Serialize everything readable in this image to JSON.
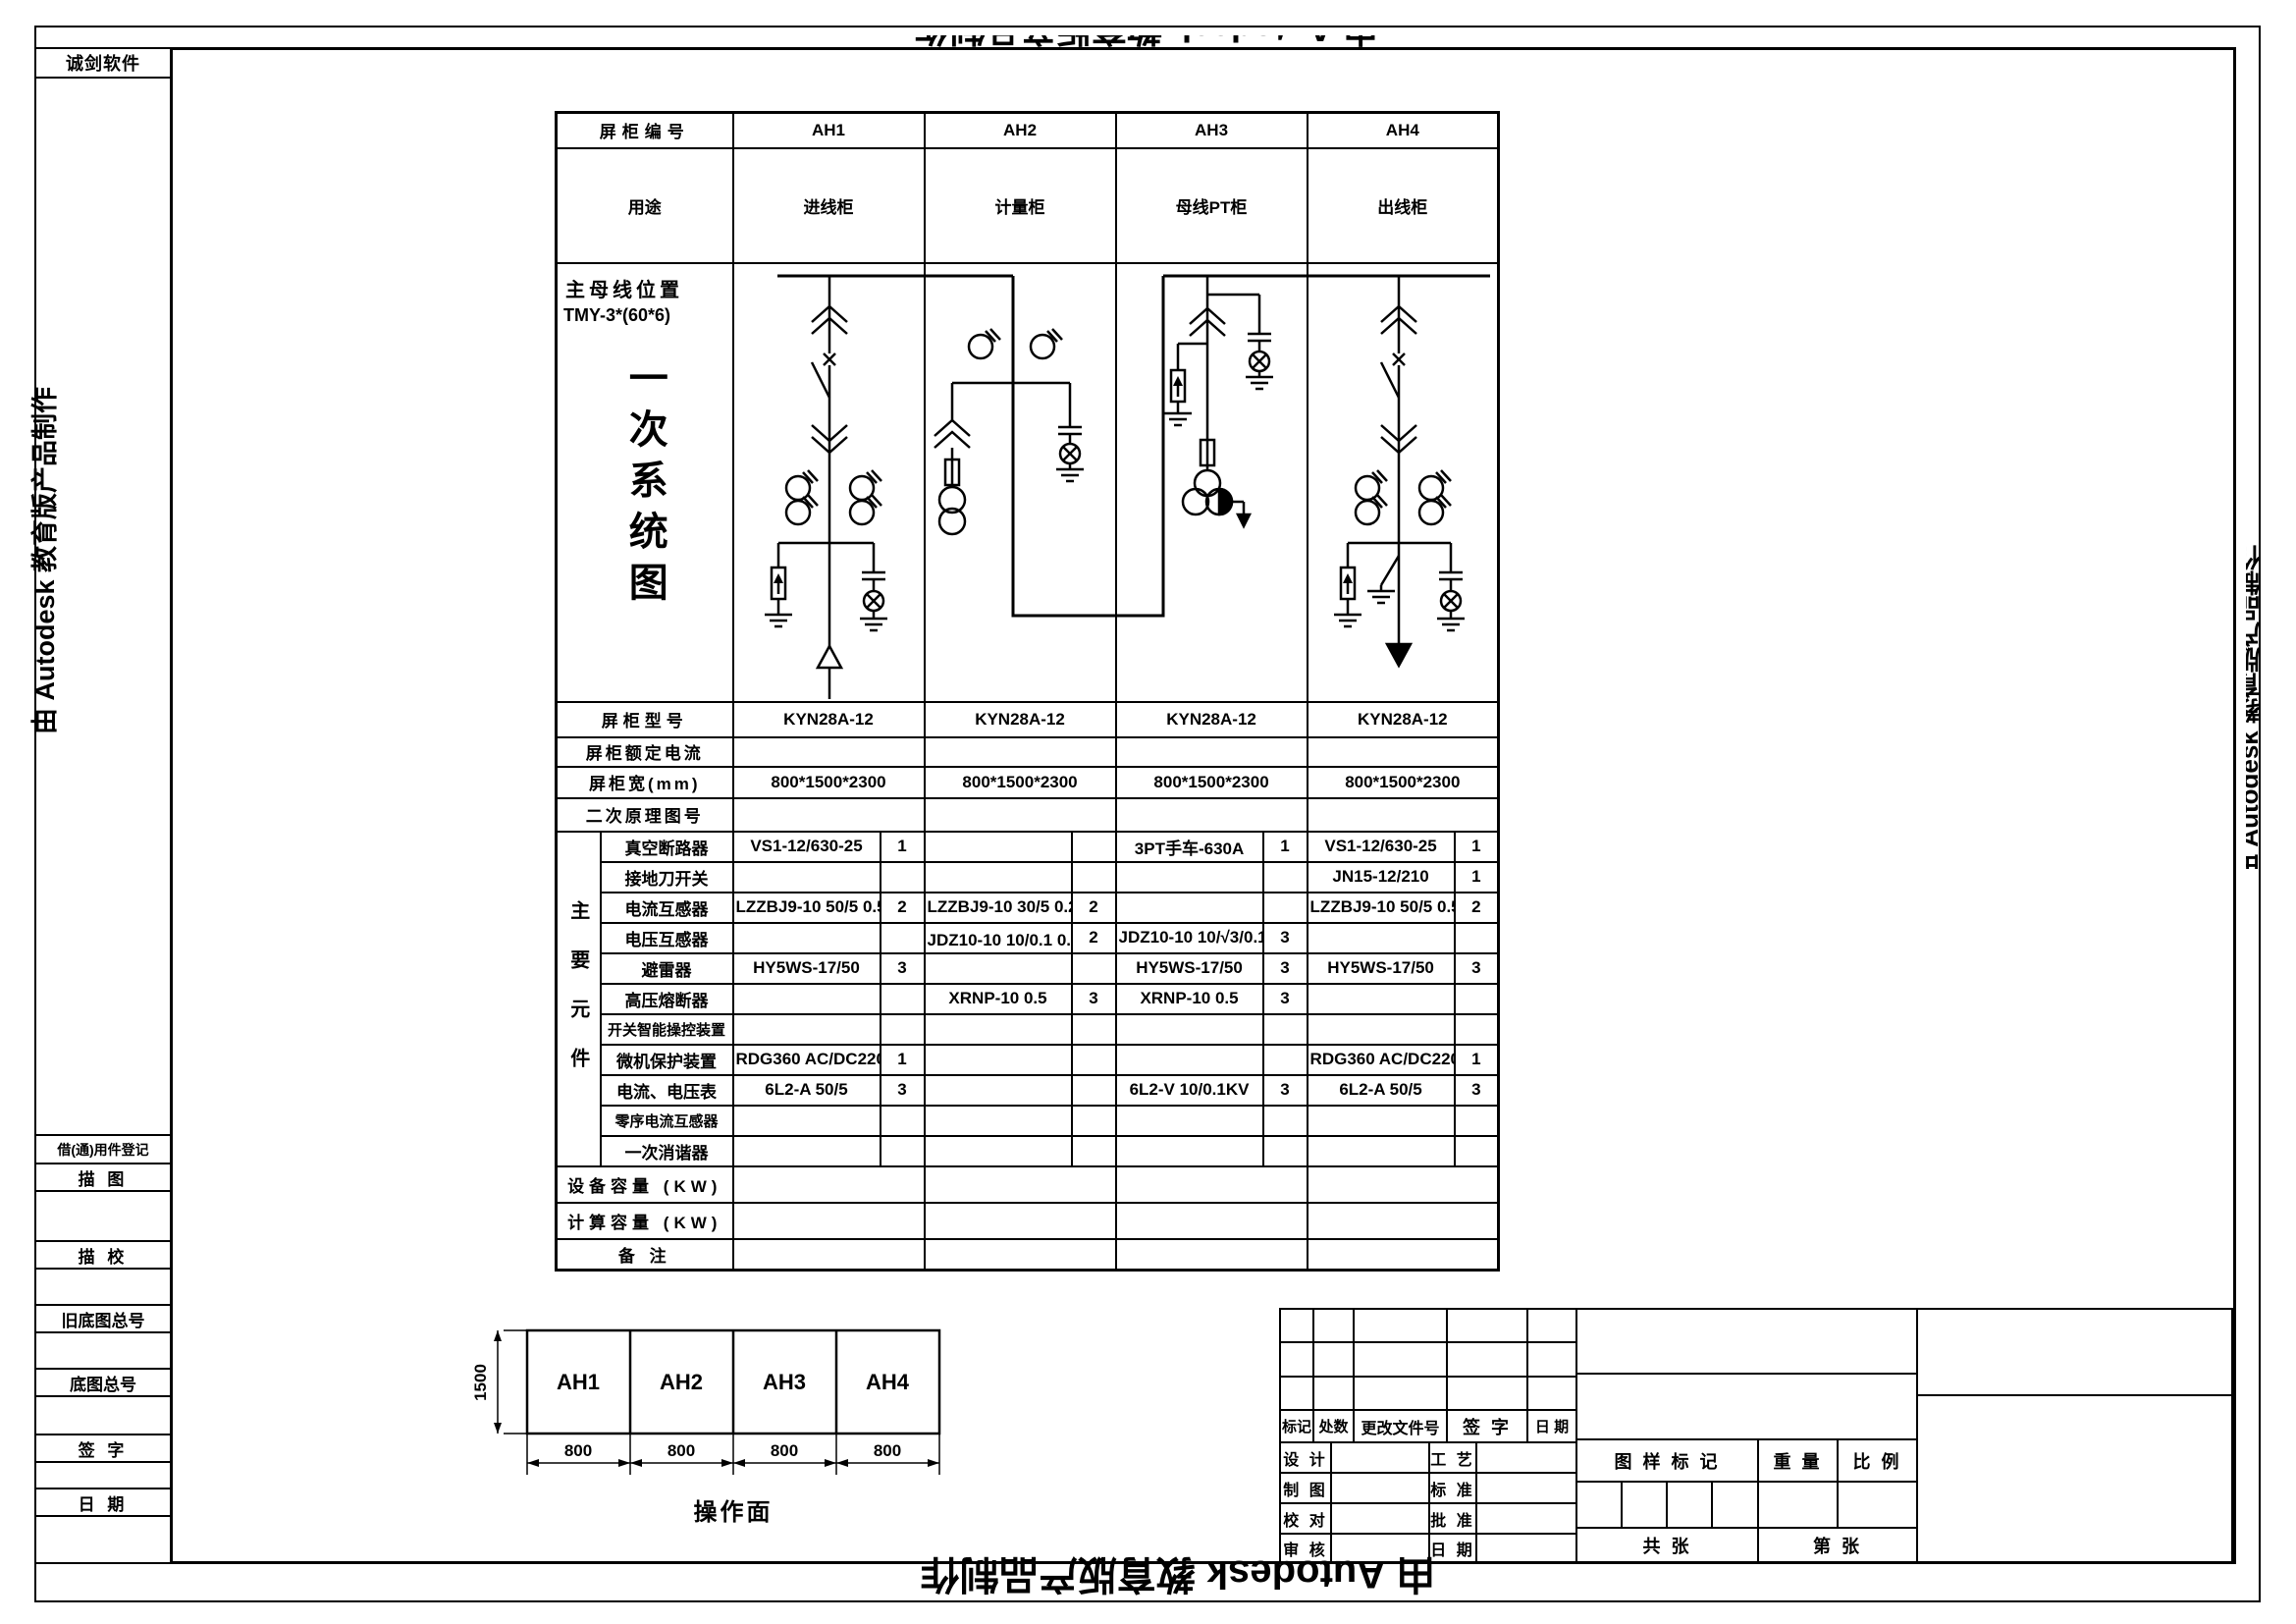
{
  "watermark": {
    "text": "由 Autodesk 教育版产品制作"
  },
  "sidebar": {
    "vendor": "诚剑软件",
    "rows": [
      "借(通)用件登记",
      "描  图",
      "描  校",
      "旧底图总号",
      "底图总号",
      "签  字",
      "日  期"
    ]
  },
  "table": {
    "header_label": "屏柜编号",
    "columns": [
      "AH1",
      "AH2",
      "AH3",
      "AH4"
    ],
    "usage_label": "用途",
    "usages": [
      "进线柜",
      "计量柜",
      "母线PT柜",
      "出线柜"
    ],
    "busbar_label": "主母线位置",
    "busbar_spec": "TMY-3*(60*6)",
    "diagram_title": "一次系统图",
    "info_rows": [
      {
        "label": "屏柜型号",
        "values": [
          "KYN28A-12",
          "KYN28A-12",
          "KYN28A-12",
          "KYN28A-12"
        ]
      },
      {
        "label": "屏柜额定电流",
        "values": [
          "",
          "",
          "",
          ""
        ]
      },
      {
        "label": "屏柜宽(mm)",
        "values": [
          "800*1500*2300",
          "800*1500*2300",
          "800*1500*2300",
          "800*1500*2300"
        ]
      },
      {
        "label": "二次原理图号",
        "values": [
          "",
          "",
          "",
          ""
        ]
      }
    ],
    "components_label": "主要元件",
    "component_rows": [
      {
        "label": "真空断路器",
        "cells": [
          {
            "model": "VS1-12/630-25",
            "qty": "1"
          },
          {},
          {
            "model": "3PT手车-630A",
            "qty": "1"
          },
          {
            "model": "VS1-12/630-25",
            "qty": "1"
          }
        ]
      },
      {
        "label": "接地刀开关",
        "cells": [
          {},
          {},
          {},
          {
            "model": "JN15-12/210",
            "qty": "1"
          }
        ]
      },
      {
        "label": "电流互感器",
        "cells": [
          {
            "model": "LZZBJ9-10 50/5 0.5/10P10",
            "qty": "2"
          },
          {
            "model": "LZZBJ9-10 30/5 0.2S",
            "qty": "2"
          },
          {},
          {
            "model": "LZZBJ9-10 50/5 0.5/10P10",
            "qty": "2"
          }
        ]
      },
      {
        "label": "电压互感器",
        "cells": [
          {},
          {
            "model": "JDZ10-10 10/0.1 0.2级",
            "qty": "2"
          },
          {
            "model": "JDZ10-10 10/√3/0.1/√3/0.1/3kV",
            "qty": "3"
          },
          {}
        ]
      },
      {
        "label": "避雷器",
        "cells": [
          {
            "model": "HY5WS-17/50",
            "qty": "3"
          },
          {},
          {
            "model": "HY5WS-17/50",
            "qty": "3"
          },
          {
            "model": "HY5WS-17/50",
            "qty": "3"
          }
        ]
      },
      {
        "label": "高压熔断器",
        "cells": [
          {},
          {
            "model": "XRNP-10 0.5",
            "qty": "3"
          },
          {
            "model": "XRNP-10 0.5",
            "qty": "3"
          },
          {}
        ]
      },
      {
        "label": "开关智能操控装置",
        "cells": [
          {},
          {},
          {},
          {}
        ]
      },
      {
        "label": "微机保护装置",
        "cells": [
          {
            "model": "RDG360 AC/DC220V 5A",
            "qty": "1"
          },
          {},
          {},
          {
            "model": "RDG360 AC/DC220V 5A",
            "qty": "1"
          }
        ]
      },
      {
        "label": "电流、电压表",
        "cells": [
          {
            "model": "6L2-A 50/5",
            "qty": "3"
          },
          {},
          {
            "model": "6L2-V 10/0.1KV",
            "qty": "3"
          },
          {
            "model": "6L2-A 50/5",
            "qty": "3"
          }
        ]
      },
      {
        "label": "零序电流互感器",
        "cells": [
          {},
          {},
          {},
          {}
        ]
      },
      {
        "label": "一次消谐器",
        "cells": [
          {},
          {},
          {},
          {}
        ]
      }
    ],
    "footer_rows": [
      {
        "label": "设备容量 (KW)"
      },
      {
        "label": "计算容量 (KW)"
      },
      {
        "label": "备 注"
      }
    ]
  },
  "layout_drawing": {
    "height_dim": "1500",
    "cabinets": [
      "AH1",
      "AH2",
      "AH3",
      "AH4"
    ],
    "width_dims": [
      "800",
      "800",
      "800",
      "800"
    ],
    "caption": "操作面"
  },
  "title_block": {
    "rev_headers": [
      "标记",
      "处数",
      "更改文件号",
      "签  字",
      "日  期"
    ],
    "left_labels": [
      "设 计",
      "制 图",
      "校 对",
      "审 核"
    ],
    "mid_labels": [
      "工 艺",
      "标 准",
      "批 准",
      "日 期"
    ],
    "stamp_label": "图 样 标 记",
    "weight_label": "重 量",
    "scale_label": "比 例",
    "sheets_total": "共        张",
    "sheet_no": "第        张"
  }
}
